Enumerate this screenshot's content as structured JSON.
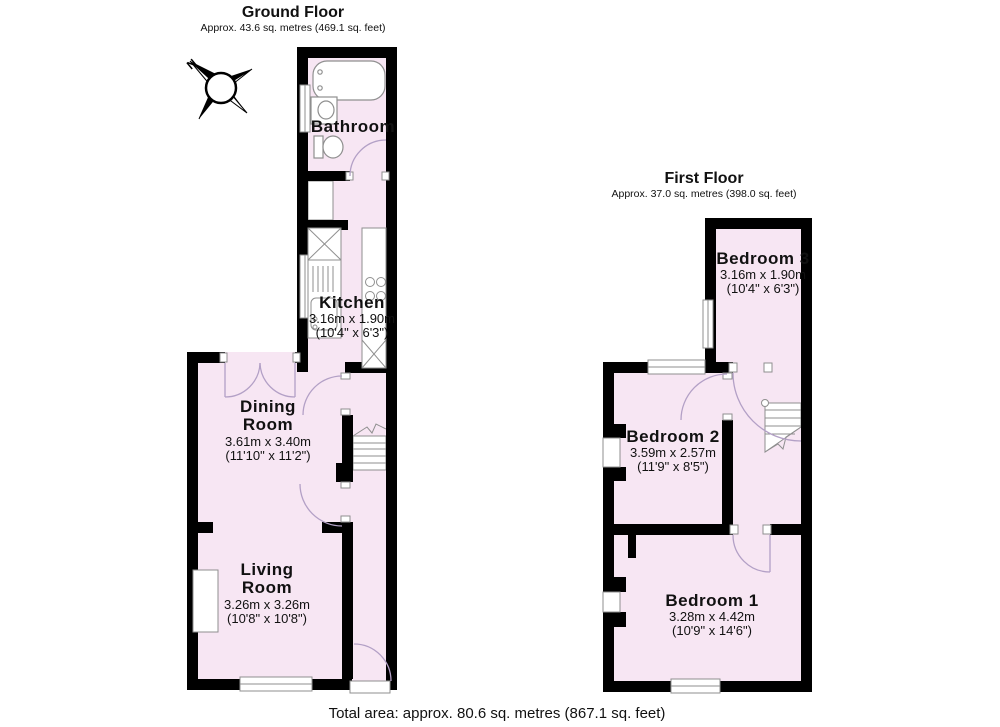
{
  "ground_floor": {
    "title": "Ground Floor",
    "subtitle": "Approx. 43.6 sq. metres (469.1 sq. feet)",
    "bathroom": {
      "name": "Bathroom"
    },
    "kitchen": {
      "name": "Kitchen",
      "metric": "3.16m x 1.90m",
      "imperial": "(10'4\" x 6'3\")"
    },
    "dining_room": {
      "name1": "Dining",
      "name2": "Room",
      "metric": "3.61m x 3.40m",
      "imperial": "(11'10\" x 11'2\")"
    },
    "living_room": {
      "name1": "Living",
      "name2": "Room",
      "metric": "3.26m x 3.26m",
      "imperial": "(10'8\" x 10'8\")"
    }
  },
  "first_floor": {
    "title": "First Floor",
    "subtitle": "Approx. 37.0 sq. metres (398.0 sq. feet)",
    "bedroom3": {
      "name": "Bedroom 3",
      "metric": "3.16m x 1.90m",
      "imperial": "(10'4\" x 6'3\")"
    },
    "bedroom2": {
      "name": "Bedroom 2",
      "metric": "3.59m x 2.57m",
      "imperial": "(11'9\" x 8'5\")"
    },
    "bedroom1": {
      "name": "Bedroom 1",
      "metric": "3.28m x 4.42m",
      "imperial": "(10'9\" x 14'6\")"
    }
  },
  "compass": {
    "north_label": "N"
  },
  "footer": {
    "total_area": "Total area: approx. 80.6 sq. metres (867.1 sq. feet)"
  },
  "colors": {
    "room_fill": "#f7e6f3",
    "wall": "#000000",
    "fixture_stroke": "#8f8f8f",
    "door_arc": "#b3a0c6"
  }
}
